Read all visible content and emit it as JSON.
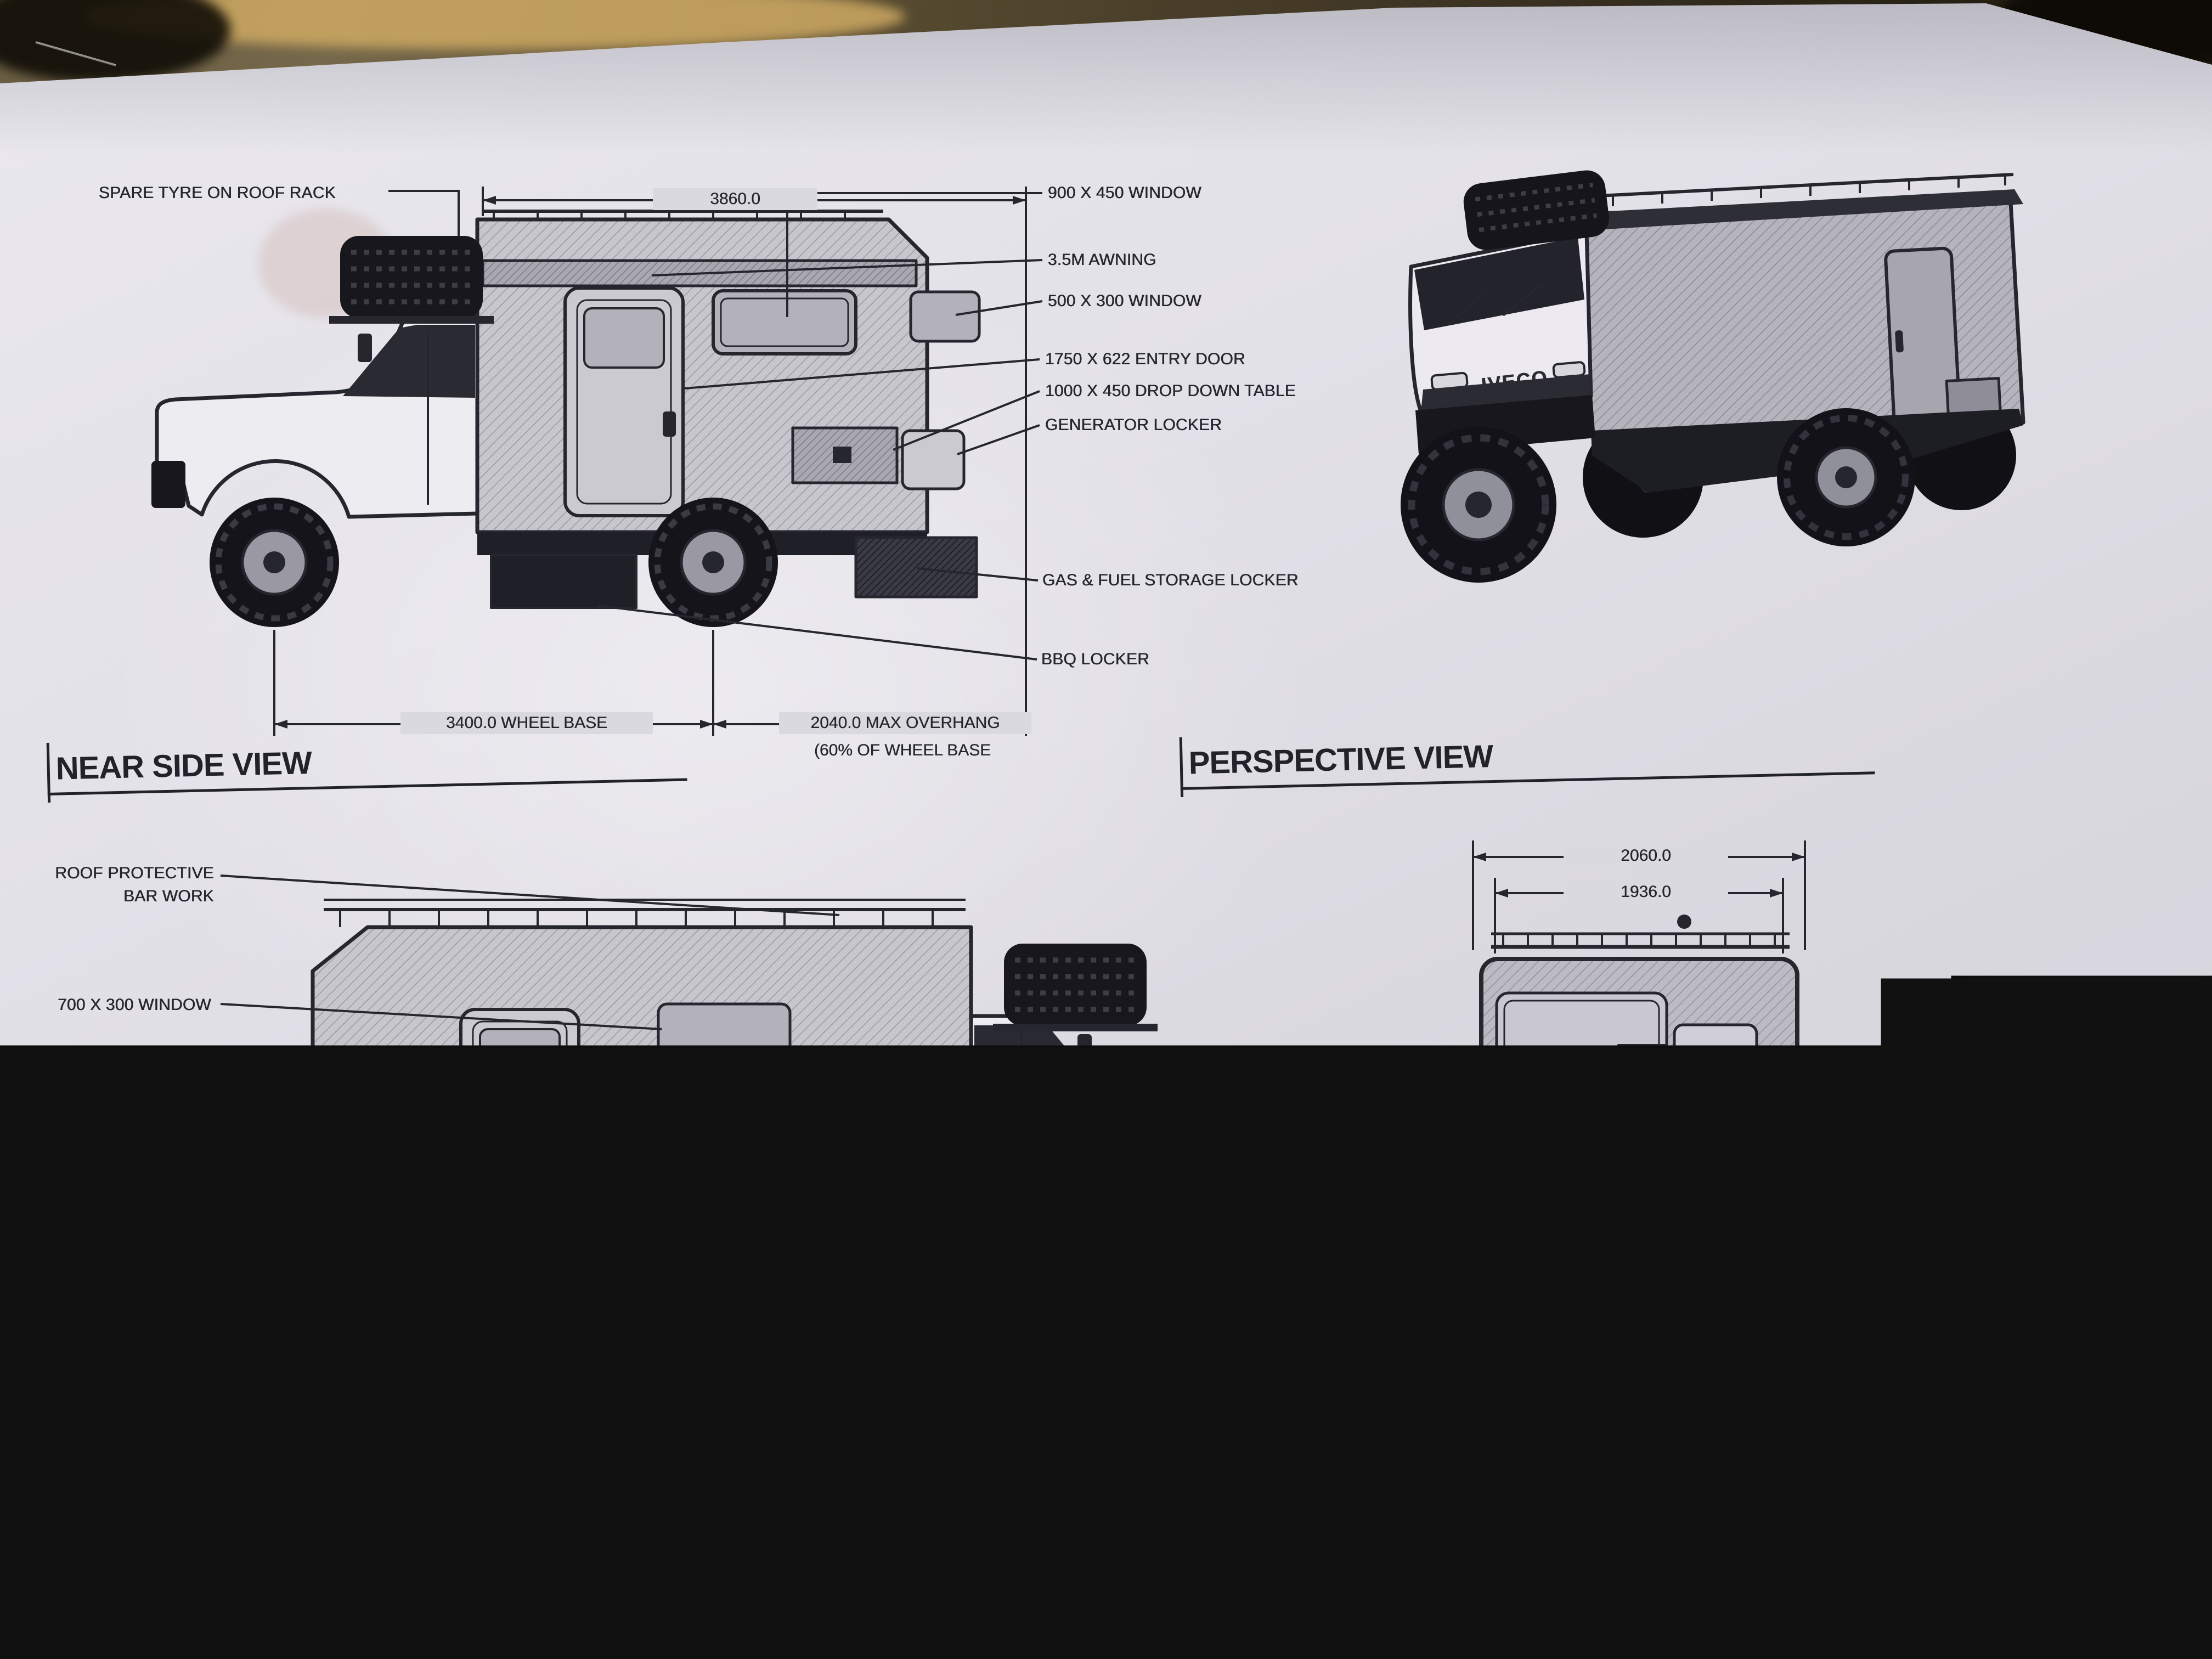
{
  "views": {
    "near_side": {
      "title": "NEAR SIDE VIEW",
      "dim_overall": "3860.0",
      "dim_wheelbase": "3400.0 WHEEL BASE",
      "dim_overhang_line1": "2040.0 MAX OVERHANG",
      "dim_overhang_line2": "(60% OF WHEEL BASE",
      "labels": {
        "spare_tyre": "SPARE TYRE ON ROOF RACK",
        "window_900": "900 X 450 WINDOW",
        "awning": "3.5M AWNING",
        "window_500": "500 X 300 WINDOW",
        "entry_door": "1750 X 622 ENTRY DOOR",
        "drop_table": "1000 X 450 DROP DOWN TABLE",
        "generator": "GENERATOR LOCKER",
        "gas_fuel": "GAS & FUEL STORAGE LOCKER",
        "bbq": "BBQ LOCKER"
      }
    },
    "perspective": {
      "title": "PERSPECTIVE VIEW",
      "badge": "IVECO"
    },
    "off_side": {
      "title": "OFF SIDE VIEW",
      "labels": {
        "roof_bar_line1": "ROOF PROTECTIVE",
        "roof_bar_line2": "BAR WORK",
        "window_700_upper": "700 X 300 WINDOW",
        "window_700_lower": "700 X 300 WINDOW",
        "storage_upper": "STORAGE LOCKER",
        "external_shower": "EXTERNAL SHOWER",
        "storage_lower": "STORAGE LOCKER",
        "fuel_tank_line1": "140L FUEL TANK & ?L",
        "fuel_tank_line2": "WATER TANK"
      }
    },
    "right_end": {
      "title": "RIGHT END VIEW",
      "dim_outer": "2060.0",
      "dim_inner": "1936.0",
      "labels": {
        "max_trax": "MAX TRAX",
        "storage": "STORAGE LOCKER"
      }
    }
  },
  "handwriting": {
    "heading": "TYRES :-",
    "rows": [
      {
        "surface": "ROAD",
        "pressure": "PSI 45"
      },
      {
        "surface": "DIRT",
        "pressure": "35"
      },
      {
        "surface": "SAND",
        "pressure": "30"
      },
      {
        "surface": "SOFTSAND",
        "pressure": "20"
      }
    ]
  },
  "general_notes": {
    "heading": "GENERAL NOT",
    "emphasis": "IF IN DOU",
    "line1": "CHECK ALL DI",
    "line2": "BEFORE CON",
    "line3": "DO NOT SCAL",
    "line4": "DRAWINGS.",
    "line5": "NOMINATED D",
    "line6": "TAKE PRECED",
    "line7": "SCALE."
  },
  "title_block": {
    "company_line1": "ALL TERRAIN",
    "company_line2": "WARRIORS",
    "tagline_line1": "MANUFACTURERS & DESIGNERS",
    "tagline_line2": "OF SPECIALIZED OFF-ROAD",
    "project_code": "PD.01",
    "drawing_number": "VE-FM-501-9002",
    "drawing_title": "IVECO DAILY 2 SLEEPER-TYPE",
    "issue_table": {
      "col_issue": "ISSUE ID:",
      "col_details": "REVISION DETAILS",
      "col_req": "REQ / REV",
      "rows": [
        {
          "id": "E",
          "details": "CONCEPT E",
          "req": "JCB"
        },
        {
          "id": "D",
          "details": "CONCEPT D",
          "req": "JCB"
        },
        {
          "id": "C",
          "details": "CONCEPT C",
          "req": "JCB"
        },
        {
          "id": "B",
          "details": "CONCEPT B",
          "req": "JCB"
        },
        {
          "id": "A",
          "details": "CONCEPT A",
          "req": ""
        }
      ]
    },
    "units_note": "ALL DIMENSIONS ARE MILLIMETRES",
    "copyright_line1": "COPYRIGHT © 2017 'ALL TERRAIN",
    "copyright_line2": "WARRIORS'. ALL RIGHTS RESERVED.",
    "legal_line": "NO PART OF THIS DESIGN AND/OR DOCUMENT",
    "sheet_size_label": "SHEET SIZE:",
    "sheet_size_value": "A3",
    "drawn_by_label": "DRAWN BY:",
    "drawn_by_value": "JCB",
    "checked_by_label": "CHECKED BY:",
    "checked_by_value": "CC",
    "sheet_number_label": "SHEET NUMBE",
    "revised_by_label": "REVISED BY",
    "issue_id_label": "ISSUE ID:"
  }
}
